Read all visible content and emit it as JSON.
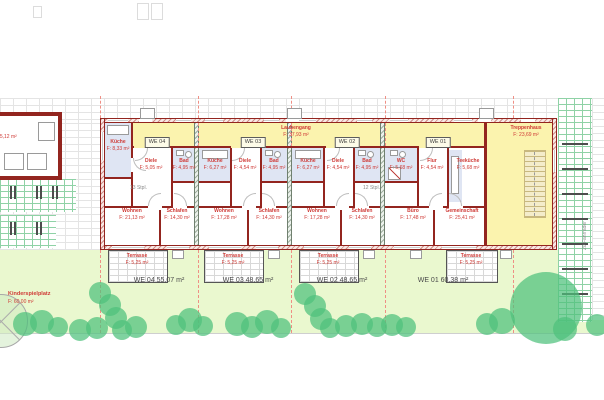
{
  "site": {
    "playground": {
      "name": "Kinderspielplatz",
      "area": "F: 60,00 m²"
    },
    "bike_storage_label": "20 Fahrräder",
    "outbuilding_area": "F: 5,12 m²",
    "parking_note_left": "13 Stpl.",
    "parking_note_right": "12 Stpl."
  },
  "building": {
    "corridor": {
      "name": "Laubengang",
      "area": "F: 37,93 m²"
    },
    "stairwell": {
      "name": "Treppenhaus",
      "area": "F: 23,69 m²"
    },
    "terrace": {
      "name": "Terrasse",
      "area": "F: 5,25 m²"
    },
    "units": [
      {
        "id": "WE 04",
        "total": "WE 04 55,07 m²",
        "rooms": [
          {
            "name": "Küche",
            "area": "F: 8,33 m²"
          },
          {
            "name": "Diele",
            "area": "F: 5,05 m²"
          },
          {
            "name": "Bad",
            "area": "F: 4,95 m²"
          },
          {
            "name": "Wohnen",
            "area": "F: 21,13 m²"
          },
          {
            "name": "Schlafen",
            "area": "F: 14,30 m²"
          }
        ]
      },
      {
        "id": "WE 03",
        "total": "WE 03 48,65 m²",
        "rooms": [
          {
            "name": "Küche",
            "area": "F: 6,27 m²"
          },
          {
            "name": "Diele",
            "area": "F: 4,54 m²"
          },
          {
            "name": "Bad",
            "area": "F: 4,95 m²"
          },
          {
            "name": "Wohnen",
            "area": "F: 17,28 m²"
          },
          {
            "name": "Schlafen",
            "area": "F: 14,30 m²"
          }
        ]
      },
      {
        "id": "WE 02",
        "total": "WE 02 48,65 m²",
        "rooms": [
          {
            "name": "Küche",
            "area": "F: 6,27 m²"
          },
          {
            "name": "Diele",
            "area": "F: 4,54 m²"
          },
          {
            "name": "Bad",
            "area": "F: 4,95 m²"
          },
          {
            "name": "Wohnen",
            "area": "F: 17,28 m²"
          },
          {
            "name": "Schlafen",
            "area": "F: 14,30 m²"
          }
        ]
      },
      {
        "id": "WE 01",
        "total": "WE 01 60,38 m²",
        "rooms": [
          {
            "name": "WC",
            "area": "F: 5,68 m²"
          },
          {
            "name": "Flur",
            "area": "F: 4,54 m²"
          },
          {
            "name": "Teeküche",
            "area": "F: 5,68 m²"
          },
          {
            "name": "Büro",
            "area": "F: 17,48 m²"
          },
          {
            "name": "Gemeinschaft",
            "area": "F: 25,41 m²"
          }
        ]
      }
    ]
  },
  "colors": {
    "wall_red": "#93251f",
    "corridor_yellow": "#fbf3ae",
    "room_blue": "#dfe5f3",
    "lawn_green": "#eaf8cf",
    "bush_green": "#4ec07c",
    "label_red": "#cf3a36"
  }
}
